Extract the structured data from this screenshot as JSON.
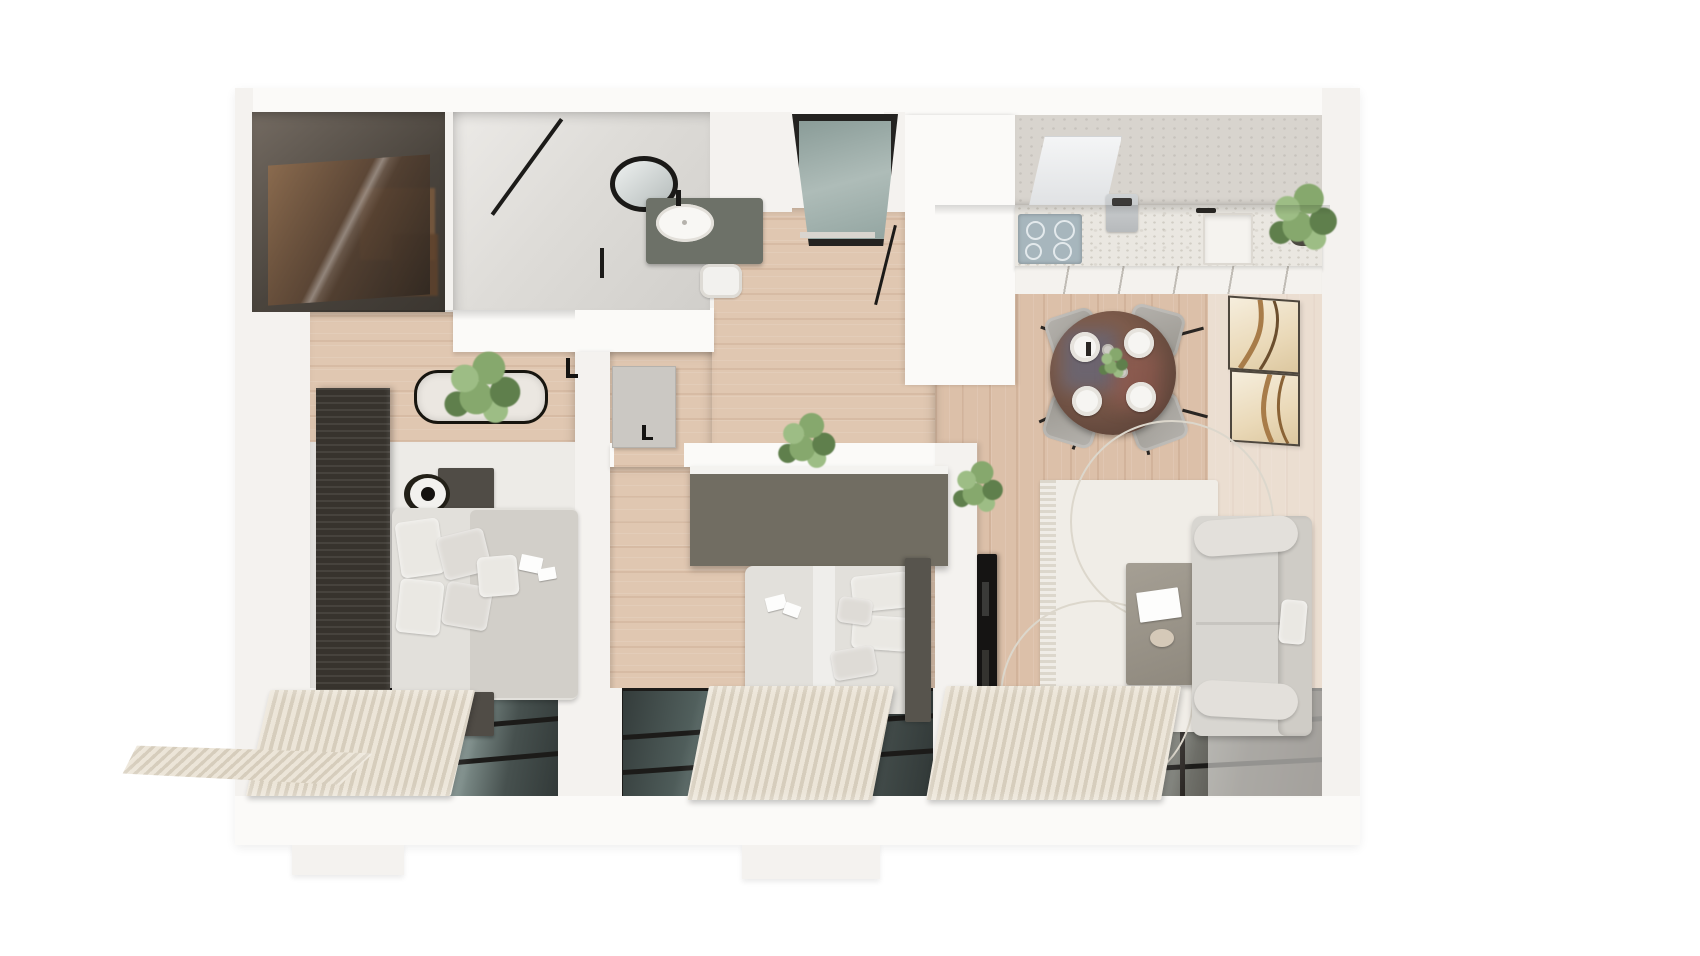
{
  "meta": {
    "title": "3D apartment floor plan - top-down render",
    "view": "top-down isometric render",
    "background": "#ffffff"
  },
  "palette": {
    "wall": "#f4f2ef",
    "wall_bright": "#fbfaf8",
    "floor_wood": "#dcc0a9",
    "floor_wood_light": "#e0c7b1",
    "floor_pale": "#edebe7",
    "concrete": "#d8d4ce",
    "slat_wall": "#37332d",
    "bed_linen": "#e2e0db",
    "pillow": "#eae8e3",
    "blanket": "#d2cfc9",
    "nightstand": "#504c46",
    "wardrobe": "#716d62",
    "headboard": "#57544d",
    "door_glass": "#8fa29e",
    "frame_black": "#1c1b19",
    "counter": "#eae7e1",
    "cabinet_front": "#f4f2ee",
    "cooktop": "#a7b6bd",
    "vanity": "#6d7168",
    "table_wood": "#6f5143",
    "plate": "#f6f5f2",
    "rug": "#f0ede7",
    "coffee_table": "#9c968c",
    "sofa": "#d8d6d1",
    "sofa_back": "#cfccc6",
    "tv": "#151413",
    "curtain_light": "#ece5d8",
    "curtain_dark": "#d6cdbc",
    "plant": "#86a86d",
    "plant_light": "#9dbd85",
    "plant_dark": "#5f7f4c",
    "pot": "#4a473f"
  },
  "rooms": {
    "closet": {
      "name": "walk-in closet",
      "items": [
        "smoked-glass wardrobe",
        "wood shelving"
      ]
    },
    "bathroom": {
      "name": "bathroom",
      "items": [
        "walk-in shower",
        "round mirror",
        "vanity with basin",
        "black faucet",
        "toilet"
      ]
    },
    "hallway": {
      "name": "entrance hall",
      "items": [
        "entrance door with glass",
        "coat stand"
      ]
    },
    "kitchen": {
      "name": "kitchen",
      "items": [
        "stone countertop",
        "induction hob",
        "extractor hood",
        "coffee maker",
        "sink",
        "potted plant"
      ]
    },
    "dining": {
      "name": "dining area",
      "items": [
        "round dining table",
        "4 upholstered chairs",
        "4 place settings",
        "centerpiece plant"
      ]
    },
    "living": {
      "name": "living room",
      "items": [
        "wall-mounted tv",
        "area rug",
        "coffee table with book",
        "three-seat sofa",
        "2 wall art frames",
        "plant"
      ]
    },
    "bedroom1": {
      "name": "bedroom 1",
      "items": [
        "slatted accent wall",
        "double bed",
        "2 nightstands",
        "2 ring lamps",
        "bench with plant",
        "window with curtains"
      ]
    },
    "bedroom2": {
      "name": "bedroom 2",
      "items": [
        "wardrobe",
        "double bed with headboard",
        "open door",
        "plant",
        "window with curtains"
      ]
    },
    "exterior": {
      "name": "window band",
      "items": [
        "3 black-framed glazed windows",
        "pleated curtains",
        "curtain spill at cut wall"
      ]
    }
  },
  "counts": {
    "windows": 3,
    "dining_chairs": 4,
    "plates": 4,
    "art_frames": 2,
    "beds": 2,
    "lamps": 2
  }
}
